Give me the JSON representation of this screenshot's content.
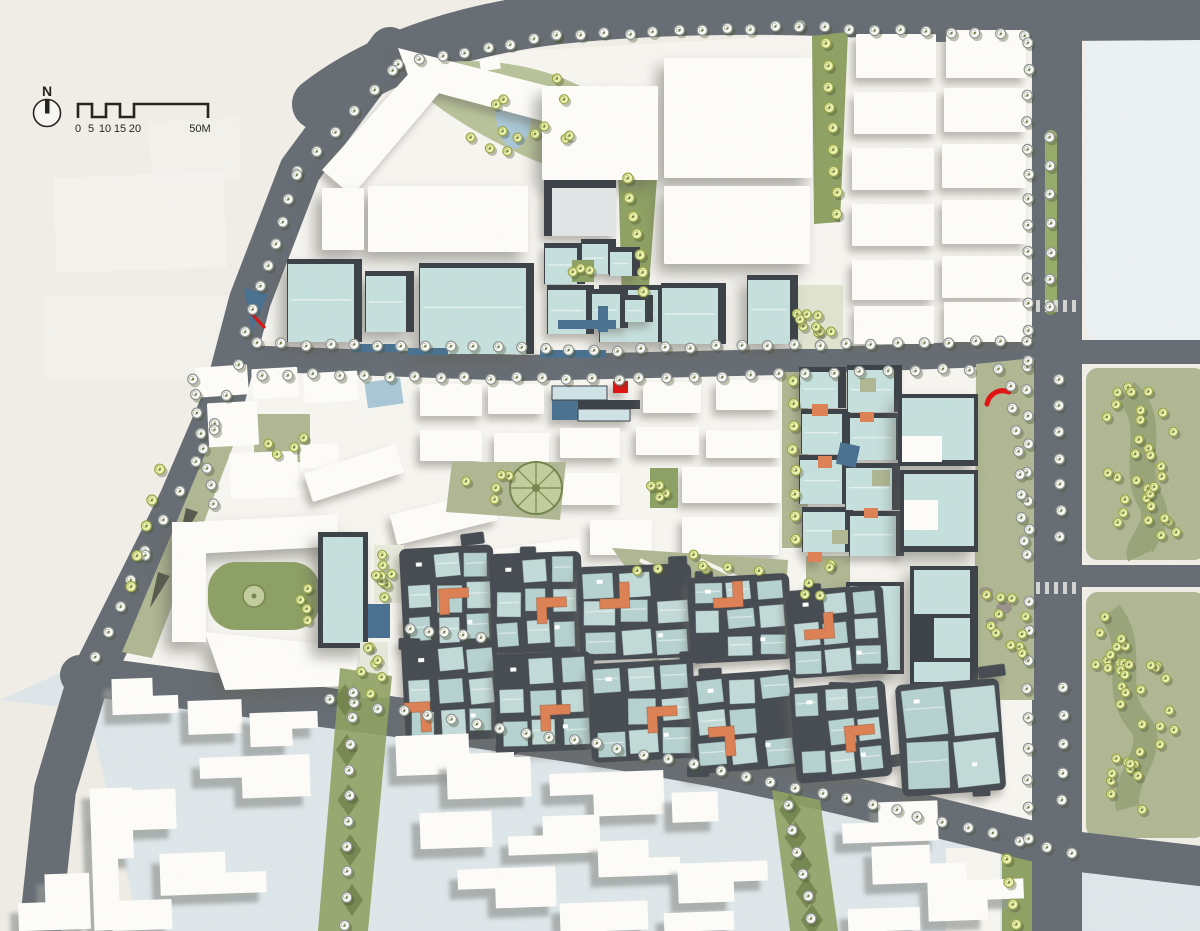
{
  "compass": {
    "label": "N"
  },
  "scale_bar": {
    "ticks": [
      "0",
      "5",
      "10",
      "15",
      "20"
    ],
    "end_label": "50M"
  },
  "palette": {
    "bg": "#f1eee7",
    "plate": "#f7f5f0",
    "ctxblue": "#e0e8eb",
    "ctxcream": "#efece5",
    "pale": "#ecf2f4",
    "road": "#676d74",
    "bwhite": "#fdfcf8",
    "bgray": "#e2e5e6",
    "teal": "#c6e0dd",
    "tealL": "#cfe2e6",
    "tealres": "#b6d2d0",
    "tealres2": "#c3dbd8",
    "frame": "#3d4249",
    "darkres": "#474c53",
    "orange": "#dd8155",
    "sage": "#b0b793",
    "lawn": "#8da065",
    "strip": "#8fa164",
    "gdark": "#6f7f4a",
    "olive": "#95a176",
    "treey": "#edf2b4",
    "treeyring": "#98a648",
    "treew": "#fbfbf7",
    "treewring": "#8f958f",
    "water": "#a9c7d6",
    "steel": "#4a7190",
    "red": "#e01313",
    "median": "#97ac6a",
    "ink": "#24241f",
    "gray": "#9ba0a4"
  },
  "map": {
    "north_halls": [
      [
        542,
        86,
        116,
        94
      ],
      [
        664,
        58,
        148,
        120
      ],
      [
        368,
        186,
        160,
        66
      ],
      [
        664,
        186,
        146,
        78
      ],
      [
        322,
        188,
        42,
        62
      ]
    ],
    "north_grid": [
      [
        856,
        34,
        80,
        44
      ],
      [
        946,
        30,
        80,
        48
      ],
      [
        854,
        92,
        82,
        42
      ],
      [
        944,
        88,
        82,
        44
      ],
      [
        852,
        148,
        82,
        42
      ],
      [
        942,
        144,
        84,
        44
      ],
      [
        852,
        204,
        82,
        42
      ],
      [
        942,
        200,
        84,
        44
      ],
      [
        852,
        260,
        82,
        40
      ],
      [
        942,
        256,
        84,
        42
      ],
      [
        854,
        306,
        80,
        38
      ],
      [
        944,
        302,
        82,
        40
      ]
    ],
    "teal_halls": [
      [
        288,
        264,
        66,
        78
      ],
      [
        366,
        276,
        40,
        56
      ],
      [
        420,
        268,
        106,
        86
      ],
      [
        748,
        280,
        42,
        64
      ],
      [
        600,
        290,
        58,
        52
      ],
      [
        662,
        288,
        56,
        56
      ]
    ],
    "teal_cubes": [
      [
        545,
        248,
        32,
        36
      ],
      [
        582,
        244,
        26,
        30
      ],
      [
        610,
        252,
        22,
        24
      ],
      [
        548,
        290,
        38,
        44
      ],
      [
        592,
        294,
        28,
        34
      ],
      [
        625,
        300,
        20,
        22
      ]
    ],
    "canals": [
      [
        558,
        320,
        58,
        9
      ],
      [
        598,
        306,
        10,
        26
      ],
      [
        540,
        350,
        66,
        8
      ],
      [
        352,
        344,
        52,
        8
      ],
      [
        408,
        348,
        40,
        7
      ]
    ],
    "mid_slabs": [
      [
        420,
        384,
        62,
        32
      ],
      [
        488,
        384,
        56,
        30
      ],
      [
        643,
        382,
        58,
        31
      ],
      [
        716,
        380,
        62,
        30
      ],
      [
        420,
        430,
        62,
        31
      ],
      [
        494,
        433,
        55,
        29
      ],
      [
        560,
        428,
        60,
        30
      ],
      [
        636,
        427,
        63,
        28
      ],
      [
        706,
        430,
        74,
        28
      ],
      [
        560,
        473,
        60,
        32
      ],
      [
        682,
        467,
        99,
        36
      ],
      [
        590,
        520,
        62,
        35
      ],
      [
        682,
        517,
        97,
        38
      ]
    ],
    "tilted_slabs": [
      [
        306,
        458,
        96,
        30,
        -18
      ],
      [
        392,
        502,
        104,
        31,
        -14
      ],
      [
        470,
        545,
        112,
        32,
        -8
      ]
    ],
    "village_whites": [
      [
        196,
        366,
        52,
        30,
        -4
      ],
      [
        252,
        368,
        46,
        30,
        -3
      ],
      [
        304,
        372,
        54,
        30,
        -3
      ],
      [
        208,
        402,
        50,
        44,
        -3
      ],
      [
        230,
        452,
        68,
        46,
        -2
      ],
      [
        300,
        444,
        38,
        24,
        -2
      ],
      [
        292,
        478,
        26,
        16,
        0
      ],
      [
        320,
        480,
        20,
        14,
        0
      ]
    ],
    "village_greens": [
      [
        254,
        414,
        56,
        48
      ],
      [
        246,
        468,
        16,
        12
      ],
      [
        264,
        482,
        16,
        12
      ]
    ],
    "campus_teal": [
      [
        800,
        372,
        38,
        36
      ],
      [
        802,
        414,
        40,
        40
      ],
      [
        800,
        460,
        42,
        44
      ],
      [
        803,
        512,
        42,
        40
      ],
      [
        848,
        370,
        46,
        42
      ],
      [
        850,
        418,
        46,
        42
      ],
      [
        846,
        468,
        46,
        42
      ],
      [
        850,
        516,
        46,
        40
      ]
    ],
    "campus_orange": [
      [
        812,
        404,
        16,
        12
      ],
      [
        818,
        456,
        14,
        12
      ],
      [
        860,
        412,
        14,
        10
      ],
      [
        864,
        508,
        14,
        10
      ],
      [
        808,
        552,
        14,
        10
      ]
    ],
    "campus_greens": [
      [
        860,
        378,
        16,
        14
      ],
      [
        872,
        470,
        18,
        16
      ],
      [
        832,
        530,
        16,
        14
      ]
    ],
    "residential_clusters": [
      [
        402,
        552,
        88,
        95,
        -3,
        0
      ],
      [
        492,
        557,
        86,
        94,
        -2,
        0
      ],
      [
        580,
        570,
        108,
        88,
        -2,
        0
      ],
      [
        690,
        581,
        96,
        80,
        -3,
        0
      ],
      [
        788,
        594,
        92,
        82,
        -4,
        0
      ],
      [
        404,
        648,
        90,
        92,
        -3,
        0
      ],
      [
        496,
        657,
        92,
        93,
        -2,
        0
      ],
      [
        590,
        667,
        100,
        93,
        -3,
        0
      ],
      [
        692,
        679,
        98,
        92,
        -4,
        0
      ],
      [
        792,
        691,
        90,
        90,
        -5,
        0
      ],
      [
        898,
        688,
        98,
        106,
        -4,
        1
      ]
    ],
    "south_slabs": [
      [
        112,
        678,
        66,
        36,
        2
      ],
      [
        188,
        700,
        54,
        34,
        -1
      ],
      [
        250,
        712,
        68,
        34,
        1
      ],
      [
        200,
        756,
        110,
        42,
        3
      ],
      [
        96,
        790,
        80,
        40,
        0
      ],
      [
        160,
        852,
        106,
        42,
        2
      ],
      [
        112,
        900,
        60,
        30,
        -1
      ],
      [
        92,
        788,
        42,
        142,
        1
      ],
      [
        18,
        874,
        72,
        56,
        0
      ],
      [
        396,
        734,
        118,
        40,
        2
      ],
      [
        447,
        758,
        84,
        40,
        -1
      ],
      [
        550,
        772,
        114,
        44,
        3
      ],
      [
        672,
        792,
        46,
        30,
        -1
      ],
      [
        508,
        816,
        92,
        38,
        0
      ],
      [
        598,
        840,
        82,
        36,
        2
      ],
      [
        678,
        862,
        90,
        40,
        1
      ],
      [
        420,
        812,
        72,
        36,
        -1
      ],
      [
        458,
        868,
        98,
        40,
        3
      ],
      [
        560,
        902,
        88,
        29,
        -1
      ],
      [
        664,
        912,
        70,
        19,
        -1
      ],
      [
        842,
        802,
        96,
        40,
        0
      ],
      [
        872,
        845,
        94,
        38,
        2
      ],
      [
        928,
        880,
        96,
        40,
        1
      ],
      [
        848,
        908,
        72,
        23,
        -1
      ]
    ],
    "tree_lines": [
      [
        398,
        64,
        556,
        36,
        8,
        "w"
      ],
      [
        556,
        36,
        800,
        26,
        11,
        "w"
      ],
      [
        800,
        26,
        1026,
        36,
        10,
        "w"
      ],
      [
        392,
        70,
        298,
        172,
        6,
        "w"
      ],
      [
        296,
        176,
        246,
        332,
        8,
        "w"
      ],
      [
        238,
        364,
        216,
        424,
        3,
        "w"
      ],
      [
        214,
        430,
        146,
        550,
        5,
        "w"
      ],
      [
        144,
        556,
        96,
        656,
        5,
        "w"
      ],
      [
        258,
        344,
        618,
        350,
        16,
        "w"
      ],
      [
        640,
        348,
        1026,
        340,
        16,
        "w"
      ],
      [
        262,
        374,
        618,
        380,
        15,
        "w"
      ],
      [
        640,
        378,
        1026,
        368,
        15,
        "w"
      ],
      [
        330,
        700,
        598,
        744,
        12,
        "w"
      ],
      [
        618,
        748,
        898,
        810,
        12,
        "w"
      ],
      [
        916,
        816,
        1072,
        852,
        7,
        "w"
      ],
      [
        1028,
        44,
        1028,
        330,
        12,
        "w"
      ],
      [
        1028,
        362,
        1028,
        556,
        8,
        "w"
      ],
      [
        1028,
        600,
        1028,
        838,
        9,
        "w"
      ],
      [
        1051,
        138,
        1051,
        308,
        7,
        "w"
      ],
      [
        1060,
        380,
        1060,
        536,
        7,
        "w"
      ],
      [
        1063,
        688,
        1063,
        800,
        5,
        "w"
      ],
      [
        826,
        44,
        838,
        214,
        9,
        "y"
      ],
      [
        628,
        178,
        644,
        292,
        7,
        "y"
      ],
      [
        352,
        692,
        346,
        924,
        10,
        "w"
      ],
      [
        788,
        806,
        812,
        920,
        6,
        "w"
      ],
      [
        192,
        378,
        214,
        504,
        8,
        "w"
      ],
      [
        1012,
        386,
        1024,
        540,
        8,
        "w"
      ],
      [
        410,
        628,
        480,
        638,
        5,
        "w"
      ],
      [
        160,
        470,
        130,
        585,
        5,
        "y"
      ],
      [
        1006,
        860,
        1016,
        925,
        4,
        "y"
      ],
      [
        792,
        380,
        796,
        540,
        8,
        "y"
      ]
    ],
    "tree_clusters": [
      [
        516,
        118,
        78,
        48,
        13,
        "y"
      ],
      [
        1136,
        440,
        38,
        58,
        20,
        "y"
      ],
      [
        1152,
        508,
        40,
        36,
        12,
        "y"
      ],
      [
        1118,
        648,
        26,
        40,
        12,
        "y"
      ],
      [
        1146,
        706,
        40,
        48,
        16,
        "y"
      ],
      [
        1122,
        788,
        28,
        42,
        10,
        "y"
      ],
      [
        700,
        568,
        66,
        14,
        7,
        "y"
      ],
      [
        282,
        442,
        26,
        16,
        4,
        "y"
      ],
      [
        307,
        604,
        10,
        22,
        4,
        "y"
      ],
      [
        386,
        572,
        12,
        26,
        8,
        "y"
      ],
      [
        372,
        668,
        11,
        26,
        7,
        "y"
      ],
      [
        816,
        316,
        20,
        28,
        9,
        "y"
      ],
      [
        1002,
        628,
        26,
        44,
        11,
        "y"
      ],
      [
        818,
        580,
        20,
        24,
        5,
        "y"
      ],
      [
        660,
        484,
        10,
        14,
        4,
        "y"
      ],
      [
        492,
        488,
        30,
        16,
        5,
        "y"
      ],
      [
        582,
        270,
        10,
        8,
        3,
        "y"
      ]
    ],
    "crosswalks": [
      [
        1036,
        300
      ],
      [
        1036,
        582
      ]
    ]
  }
}
